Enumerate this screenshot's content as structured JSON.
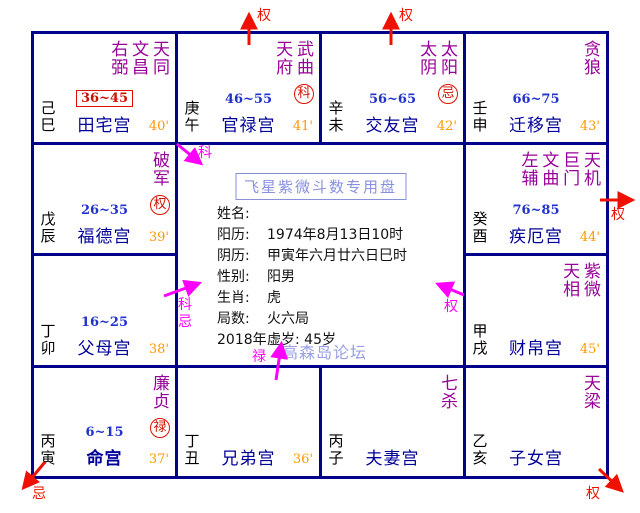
{
  "title": "飞星紫微斗数专用盘",
  "watermark": "高森岛论坛",
  "info": {
    "rows": [
      {
        "label": "姓名:",
        "value": ""
      },
      {
        "label": "阳历:",
        "value": "1974年8月13日10时"
      },
      {
        "label": "阴历:",
        "value": "甲寅年六月廿六日巳时"
      },
      {
        "label": "性别:",
        "value": "阳男"
      },
      {
        "label": "生肖:",
        "value": "虎"
      },
      {
        "label": "局数:",
        "value": "火六局"
      },
      {
        "label": "2018年",
        "value": "虚岁: 45岁"
      }
    ]
  },
  "palaces": [
    {
      "stem": "己巳",
      "name": "田宅宫",
      "age": "36~45",
      "minute": "40'",
      "stars": [
        "右弼",
        "文昌",
        "天同"
      ]
    },
    {
      "stem": "庚午",
      "name": "官禄宫",
      "age": "46~55",
      "minute": "41'",
      "stars": [
        "天府",
        "武曲"
      ],
      "hua": "科"
    },
    {
      "stem": "辛未",
      "name": "交友宫",
      "age": "56~65",
      "minute": "42'",
      "stars": [
        "太阴",
        "太阳"
      ],
      "hua": "忌"
    },
    {
      "stem": "壬申",
      "name": "迁移宫",
      "age": "66~75",
      "minute": "43'",
      "stars": [
        "贪狼"
      ]
    },
    {
      "stem": "戊辰",
      "name": "福德宫",
      "age": "26~35",
      "minute": "39'",
      "stars": [
        "破军"
      ],
      "hua": "权"
    },
    {
      "stem": "癸酉",
      "name": "疾厄宫",
      "age": "76~85",
      "minute": "44'",
      "stars": [
        "左辅",
        "文曲",
        "巨门",
        "天机"
      ]
    },
    {
      "stem": "丁卯",
      "name": "父母宫",
      "age": "16~25",
      "minute": "38'",
      "stars": []
    },
    {
      "stem": "甲戌",
      "name": "财帛宫",
      "minute": "45'",
      "stars": [
        "天相",
        "紫微"
      ]
    },
    {
      "stem": "丙寅",
      "name": "命宫",
      "age": "6~15",
      "minute": "37'",
      "stars": [
        "廉贞"
      ],
      "hua": "禄"
    },
    {
      "stem": "丁丑",
      "name": "兄弟宫",
      "minute": "36'",
      "stars": []
    },
    {
      "stem": "丙子",
      "name": "夫妻宫",
      "stars": [
        "七杀"
      ]
    },
    {
      "stem": "乙亥",
      "name": "子女宫",
      "stars": [
        "天梁"
      ]
    }
  ],
  "arrow_labels": {
    "top1": "权",
    "top2": "权",
    "right": "权",
    "bottom_left": "忌",
    "bottom_right": "权",
    "center_ke": "科",
    "left_ke": "科",
    "left_ji": "忌",
    "center_quan": "权",
    "bottom_lu": "禄"
  },
  "colors": {
    "grid_border": "#000088",
    "star_text": "#990099",
    "palace_name": "#000099",
    "age_range": "#2233cc",
    "minute_mark": "#ff9900",
    "highlight_box": "#dd1100",
    "red_arrow": "#ee1100",
    "magenta_arrow": "#ff00ff",
    "title_text": "#8890e0",
    "watermark_text": "#99a0e6"
  }
}
